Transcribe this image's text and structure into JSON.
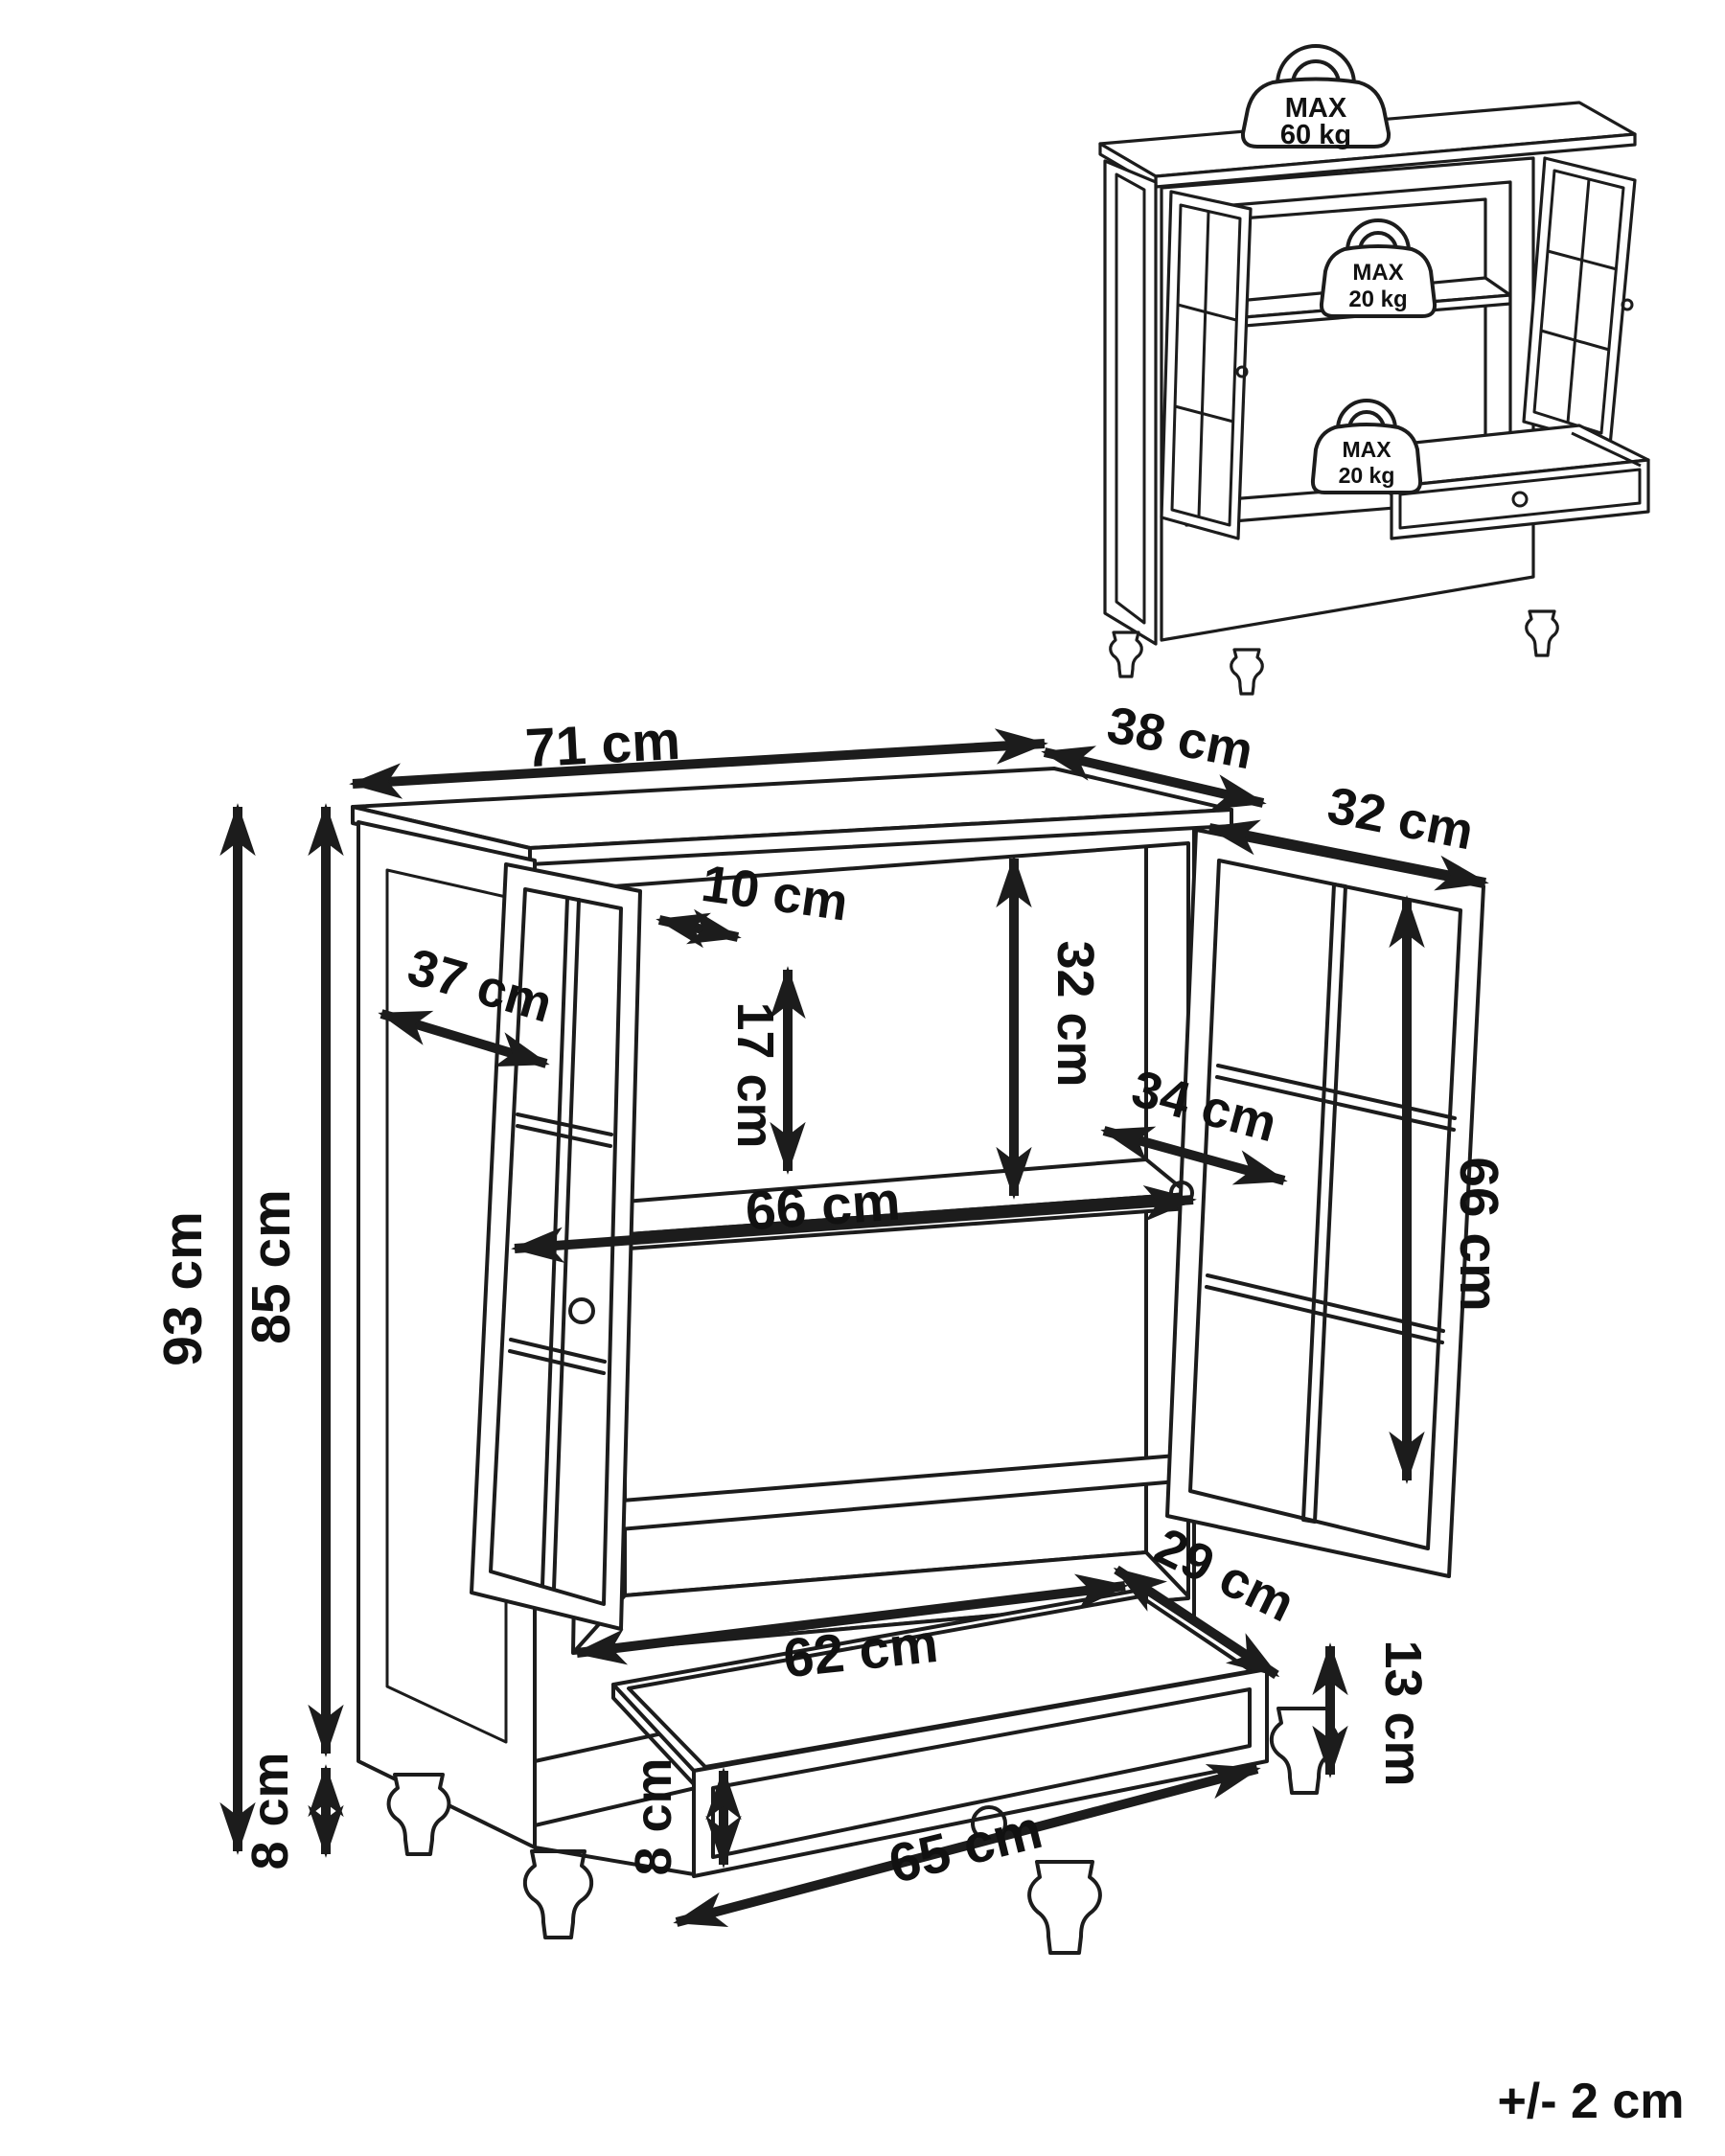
{
  "figure": {
    "type": "furniture-assembly-dimension-diagram",
    "item": "two-door display cabinet with drawer",
    "unit": "cm"
  },
  "dimensions": {
    "top_width": "71 cm",
    "top_depth": "38 cm",
    "right_door_width": "32 cm",
    "left_door_stile": "10 cm",
    "left_door_pane_height": "17 cm",
    "above_shelf_height": "32 cm",
    "side_panel_depth": "37 cm",
    "shelf_depth": "34 cm",
    "interior_width": "66 cm",
    "right_door_height": "66 cm",
    "total_height": "93 cm",
    "body_height": "85 cm",
    "leg_height": "8 cm",
    "drawer_inner_depth": "29 cm",
    "drawer_inner_width": "62 cm",
    "drawer_side_height": "13 cm",
    "drawer_front_height": "8 cm",
    "drawer_width": "65 cm"
  },
  "tolerance": "+/- 2 cm",
  "inset": {
    "weights": [
      {
        "label": "MAX",
        "value": "60 kg",
        "location": "cabinet top"
      },
      {
        "label": "MAX",
        "value": "20 kg",
        "location": "shelf"
      },
      {
        "label": "MAX",
        "value": "20 kg",
        "location": "bottom / drawer"
      }
    ]
  }
}
